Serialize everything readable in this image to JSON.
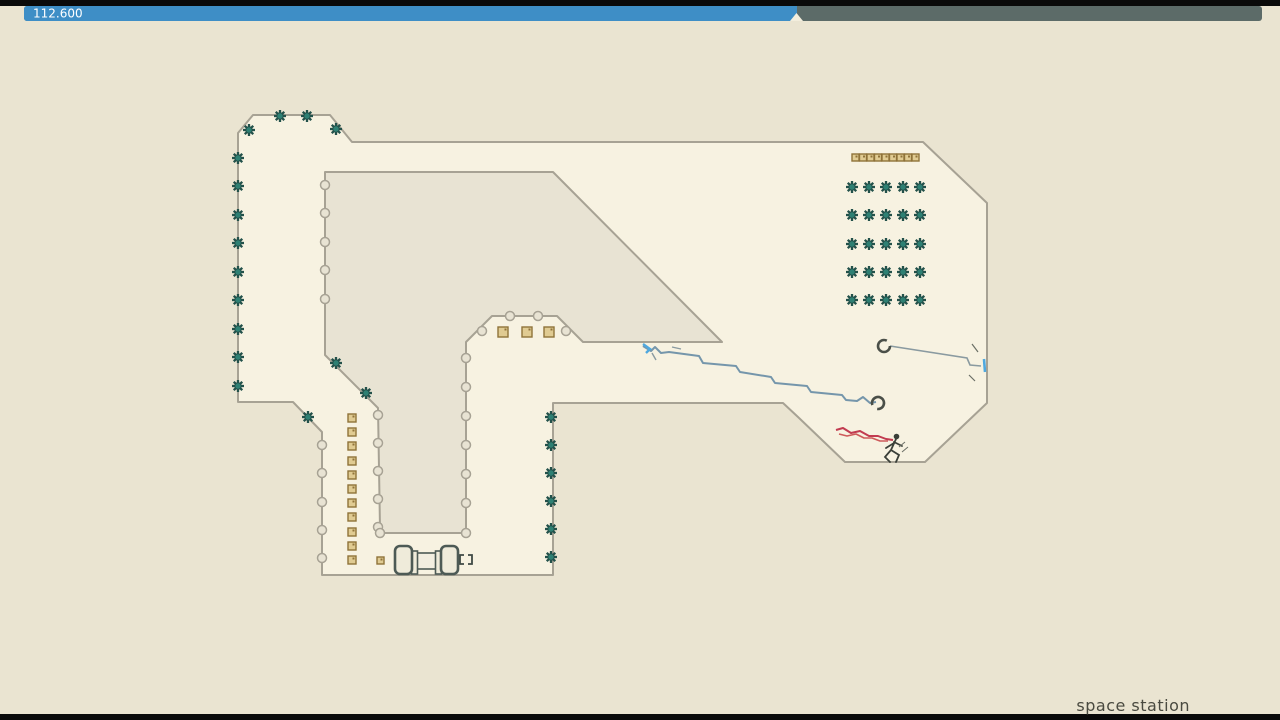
{
  "hud": {
    "timer_label": "112.600",
    "progress_fraction": 0.624,
    "colors": {
      "elapsed": "#3E8EC6",
      "remaining": "#5C6B68",
      "text": "#FFFFFF"
    }
  },
  "footer": {
    "level_name": "space station"
  },
  "palette": {
    "background": "#EAE4D1",
    "floor": "#F7F2E1",
    "island": "#E8E3D3",
    "outline": "#A7A294",
    "mine_dark": "#23514A",
    "mine_teal": "#2E8073",
    "gold_fill": "#E0CB92",
    "gold_edge": "#8F7339",
    "trail_blue": "#7596AB",
    "trail_accent": "#4FA8DF",
    "trail_red1": "#C23B50",
    "trail_red2": "#CE5A5A",
    "door": "#4D5A55",
    "ninja": "#3A3F38",
    "letterbox": "#0A0A0A"
  },
  "entities": {
    "counts": {
      "mines": 47,
      "gold": 24,
      "drones": 2
    },
    "mines": [
      [
        280,
        116
      ],
      [
        307,
        116
      ],
      [
        249,
        130
      ],
      [
        336,
        129
      ],
      [
        238,
        158
      ],
      [
        238,
        186
      ],
      [
        238,
        215
      ],
      [
        238,
        243
      ],
      [
        238,
        272
      ],
      [
        238,
        300
      ],
      [
        238,
        329
      ],
      [
        238,
        357
      ],
      [
        238,
        386
      ],
      [
        308,
        417
      ],
      [
        336,
        363
      ],
      [
        366,
        393
      ],
      [
        551,
        417
      ],
      [
        551,
        445
      ],
      [
        551,
        473
      ],
      [
        551,
        501
      ],
      [
        551,
        529
      ],
      [
        551,
        557
      ],
      [
        852,
        187
      ],
      [
        869,
        187
      ],
      [
        886,
        187
      ],
      [
        903,
        187
      ],
      [
        920,
        187
      ],
      [
        852,
        215
      ],
      [
        869,
        215
      ],
      [
        886,
        215
      ],
      [
        903,
        215
      ],
      [
        920,
        215
      ],
      [
        852,
        244
      ],
      [
        869,
        244
      ],
      [
        886,
        244
      ],
      [
        903,
        244
      ],
      [
        920,
        244
      ],
      [
        852,
        272
      ],
      [
        869,
        272
      ],
      [
        886,
        272
      ],
      [
        903,
        272
      ],
      [
        920,
        272
      ],
      [
        852,
        300
      ],
      [
        869,
        300
      ],
      [
        886,
        300
      ],
      [
        903,
        300
      ],
      [
        920,
        300
      ]
    ],
    "gold": [
      [
        852,
        154,
        7
      ],
      [
        859.5,
        154,
        7
      ],
      [
        867,
        154,
        7
      ],
      [
        874.5,
        154,
        7
      ],
      [
        882,
        154,
        7
      ],
      [
        889.5,
        154,
        7
      ],
      [
        897,
        154,
        7
      ],
      [
        904.5,
        154,
        7
      ],
      [
        912,
        154,
        7
      ],
      [
        498,
        327,
        10
      ],
      [
        522,
        327,
        10
      ],
      [
        544,
        327,
        10
      ],
      [
        348,
        414,
        8
      ],
      [
        348,
        428,
        8
      ],
      [
        348,
        442,
        8
      ],
      [
        348,
        457,
        8
      ],
      [
        348,
        471,
        8
      ],
      [
        348,
        485,
        8
      ],
      [
        348,
        499,
        8
      ],
      [
        348,
        513,
        8
      ],
      [
        348,
        528,
        8
      ],
      [
        348,
        542,
        8
      ],
      [
        348,
        556,
        8
      ],
      [
        377,
        557,
        7
      ]
    ],
    "wall_bumps": [
      [
        325,
        185
      ],
      [
        325,
        213
      ],
      [
        325,
        242
      ],
      [
        325,
        270
      ],
      [
        325,
        299
      ],
      [
        322,
        445
      ],
      [
        322,
        473
      ],
      [
        322,
        502
      ],
      [
        322,
        530
      ],
      [
        322,
        558
      ],
      [
        378,
        415
      ],
      [
        378,
        443
      ],
      [
        378,
        471
      ],
      [
        378,
        499
      ],
      [
        378,
        527
      ],
      [
        466,
        358
      ],
      [
        466,
        387
      ],
      [
        466,
        416
      ],
      [
        466,
        445
      ],
      [
        466,
        474
      ],
      [
        466,
        503
      ],
      [
        510,
        316
      ],
      [
        538,
        316
      ],
      [
        380,
        533
      ],
      [
        466,
        533
      ],
      [
        482,
        331
      ],
      [
        566,
        331
      ]
    ],
    "drones": [
      {
        "x": 884,
        "y": 346
      },
      {
        "x": 878,
        "y": 403
      }
    ],
    "trails": {
      "blue": "643,346 651,351 655,347 661,353 669,352 699,356 703,363 736,366 740,372 771,377 775,383 807,386 811,392 842,395 846,400 857,401 863,397 870,403 876,402",
      "blue_accent": "643,344 650,349 646,353",
      "tether": "890,346 967,358 970,365 981,366",
      "red1": "836,430 843,428 851,433 860,431 869,436 878,436 886,439 893,440",
      "red2": "839,434 847,436 856,434 864,438 872,438 880,441 888,441"
    }
  }
}
